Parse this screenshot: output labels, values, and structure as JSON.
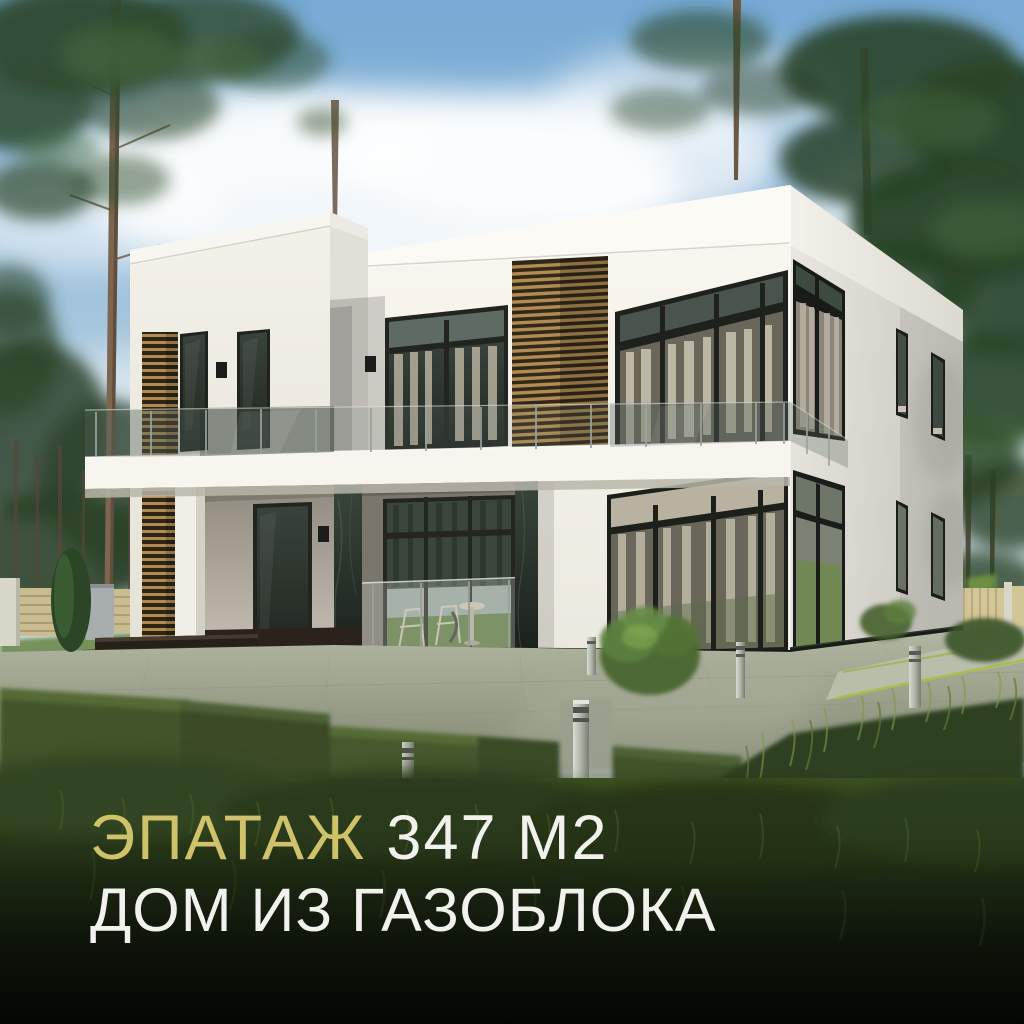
{
  "caption": {
    "line1": {
      "accent": "ЭПАТАЖ",
      "rest": "347 М2"
    },
    "line2": "ДОМ ИЗ ГАЗОБЛОКА"
  },
  "colors": {
    "accent_gold": "#cfc26a",
    "text_white": "#f1f1ee",
    "sky_blue": "#76a9d4",
    "house_white": "#f6f3ec",
    "window_frame_dark": "#1f211d",
    "wood_slat": "#b08c52",
    "marble_green_dark": "#2a352c",
    "grass_dark": "#1a2413"
  }
}
